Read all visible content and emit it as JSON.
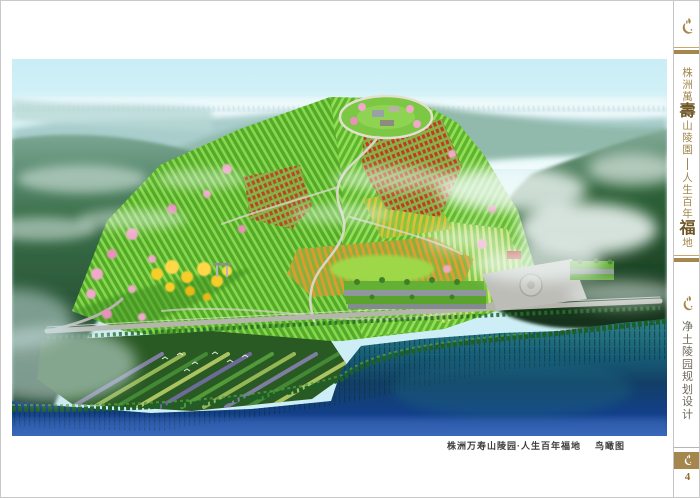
{
  "page": {
    "number": "4"
  },
  "main_image": {
    "caption_title": "株洲万寿山陵园·人生百年福地",
    "caption_type": "鸟瞰图"
  },
  "sidebar": {
    "brand": {
      "full_title": "株洲萬壽山陵園 — 人生百年福地",
      "part1": "株洲萬",
      "emph1": "壽",
      "part2": "山陵園",
      "part3": "人生百年",
      "emph2": "福",
      "part4": "地"
    },
    "section_label": "净土陵园规划设计"
  },
  "colors": {
    "gold": "#a5874e",
    "gold_dark": "#6f5626",
    "label_gray": "#6e685c",
    "caption_text": "#3d3d3d"
  }
}
